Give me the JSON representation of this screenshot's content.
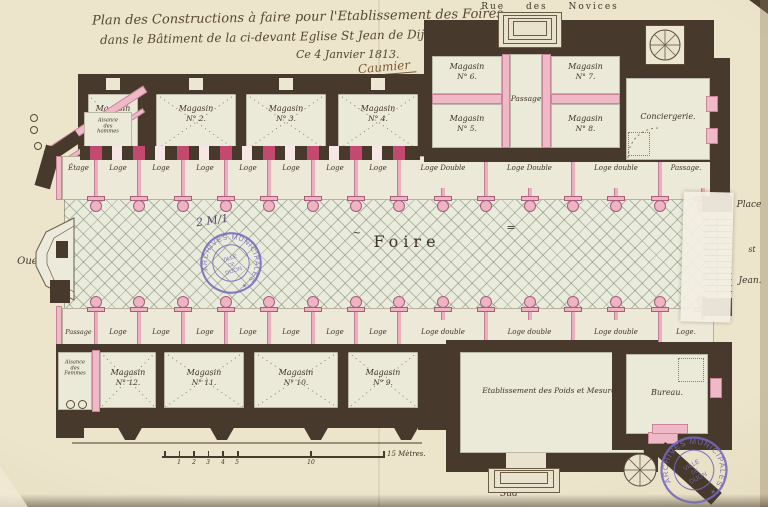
{
  "archive": {
    "ref": "2 M/1",
    "stamp_ring": "ARCHIVES MUNICIPALES ✶",
    "stamp_line1": "VILLE",
    "stamp_line2": "DE",
    "stamp_line3": "DIJON"
  },
  "title": {
    "line1": "Plan des Constructions à faire pour l'Etablissement des Foires",
    "line2": "dans le Bâtiment de la ci-devant Eglise St Jean de Dijon.",
    "date": "Ce 4 Janvier 1813.",
    "signature": "Caumier"
  },
  "orientation": {
    "north_street": "Rue des Novices",
    "west": "Ouest",
    "south": "Sud",
    "east_line1": "Place",
    "east_line2": "st",
    "east_line3": "Jean."
  },
  "hall": {
    "label": "Foire",
    "mark": "=",
    "squiggle": "~"
  },
  "magasins_top": [
    {
      "name": "Magasin",
      "no": "N° 1."
    },
    {
      "name": "Magasin",
      "no": "N° 2."
    },
    {
      "name": "Magasin",
      "no": "N° 3."
    },
    {
      "name": "Magasin",
      "no": "N° 4."
    }
  ],
  "transept": {
    "m6_name": "Magasin",
    "m6_no": "N° 6.",
    "m7_name": "Magasin",
    "m7_no": "N° 7.",
    "passage": "Passage",
    "m5_name": "Magasin",
    "m5_no": "N° 5.",
    "m8_name": "Magasin",
    "m8_no": "N° 8.",
    "conciergerie": "Conciergerie."
  },
  "magasins_bottom": [
    {
      "name": "Magasin",
      "no": "N° 12."
    },
    {
      "name": "Magasin",
      "no": "N° 11."
    },
    {
      "name": "Magasin",
      "no": "N° 10."
    },
    {
      "name": "Magasin",
      "no": "N° 9."
    }
  ],
  "top_row": {
    "first": "Étage",
    "loges": [
      "Loge",
      "Loge",
      "Loge",
      "Loge",
      "Loge",
      "Loge",
      "Loge"
    ],
    "doubles": [
      "Loge Double",
      "Loge Double",
      "Loge double"
    ],
    "last": "Passage."
  },
  "bottom_row": {
    "first": "Passage",
    "loges": [
      "Loge",
      "Loge",
      "Loge",
      "Loge",
      "Loge",
      "Loge",
      "Loge"
    ],
    "doubles": [
      "Loge double",
      "Loge double",
      "Loge double"
    ],
    "last": "Loge."
  },
  "south_wing": {
    "weights": "Etablissement des Poids et Mesures.",
    "bureau": "Bureau."
  },
  "aisances": {
    "hommes": [
      "Aisance",
      "des",
      "hommes"
    ],
    "femmes": [
      "Aisance",
      "des",
      "Femmes"
    ]
  },
  "scale_bar": {
    "ticks": [
      "1",
      "2",
      "3",
      "4",
      "5",
      "10"
    ],
    "end_label": "15 Mètres."
  },
  "colors": {
    "wall": "#473a2d",
    "pink": "#f0b9c8",
    "crimson": "#c34a6e",
    "paper": "#e9e1c6",
    "room": "#ebe9d8",
    "stamp_violet": "#7468bd",
    "ink": "#463b2c"
  }
}
